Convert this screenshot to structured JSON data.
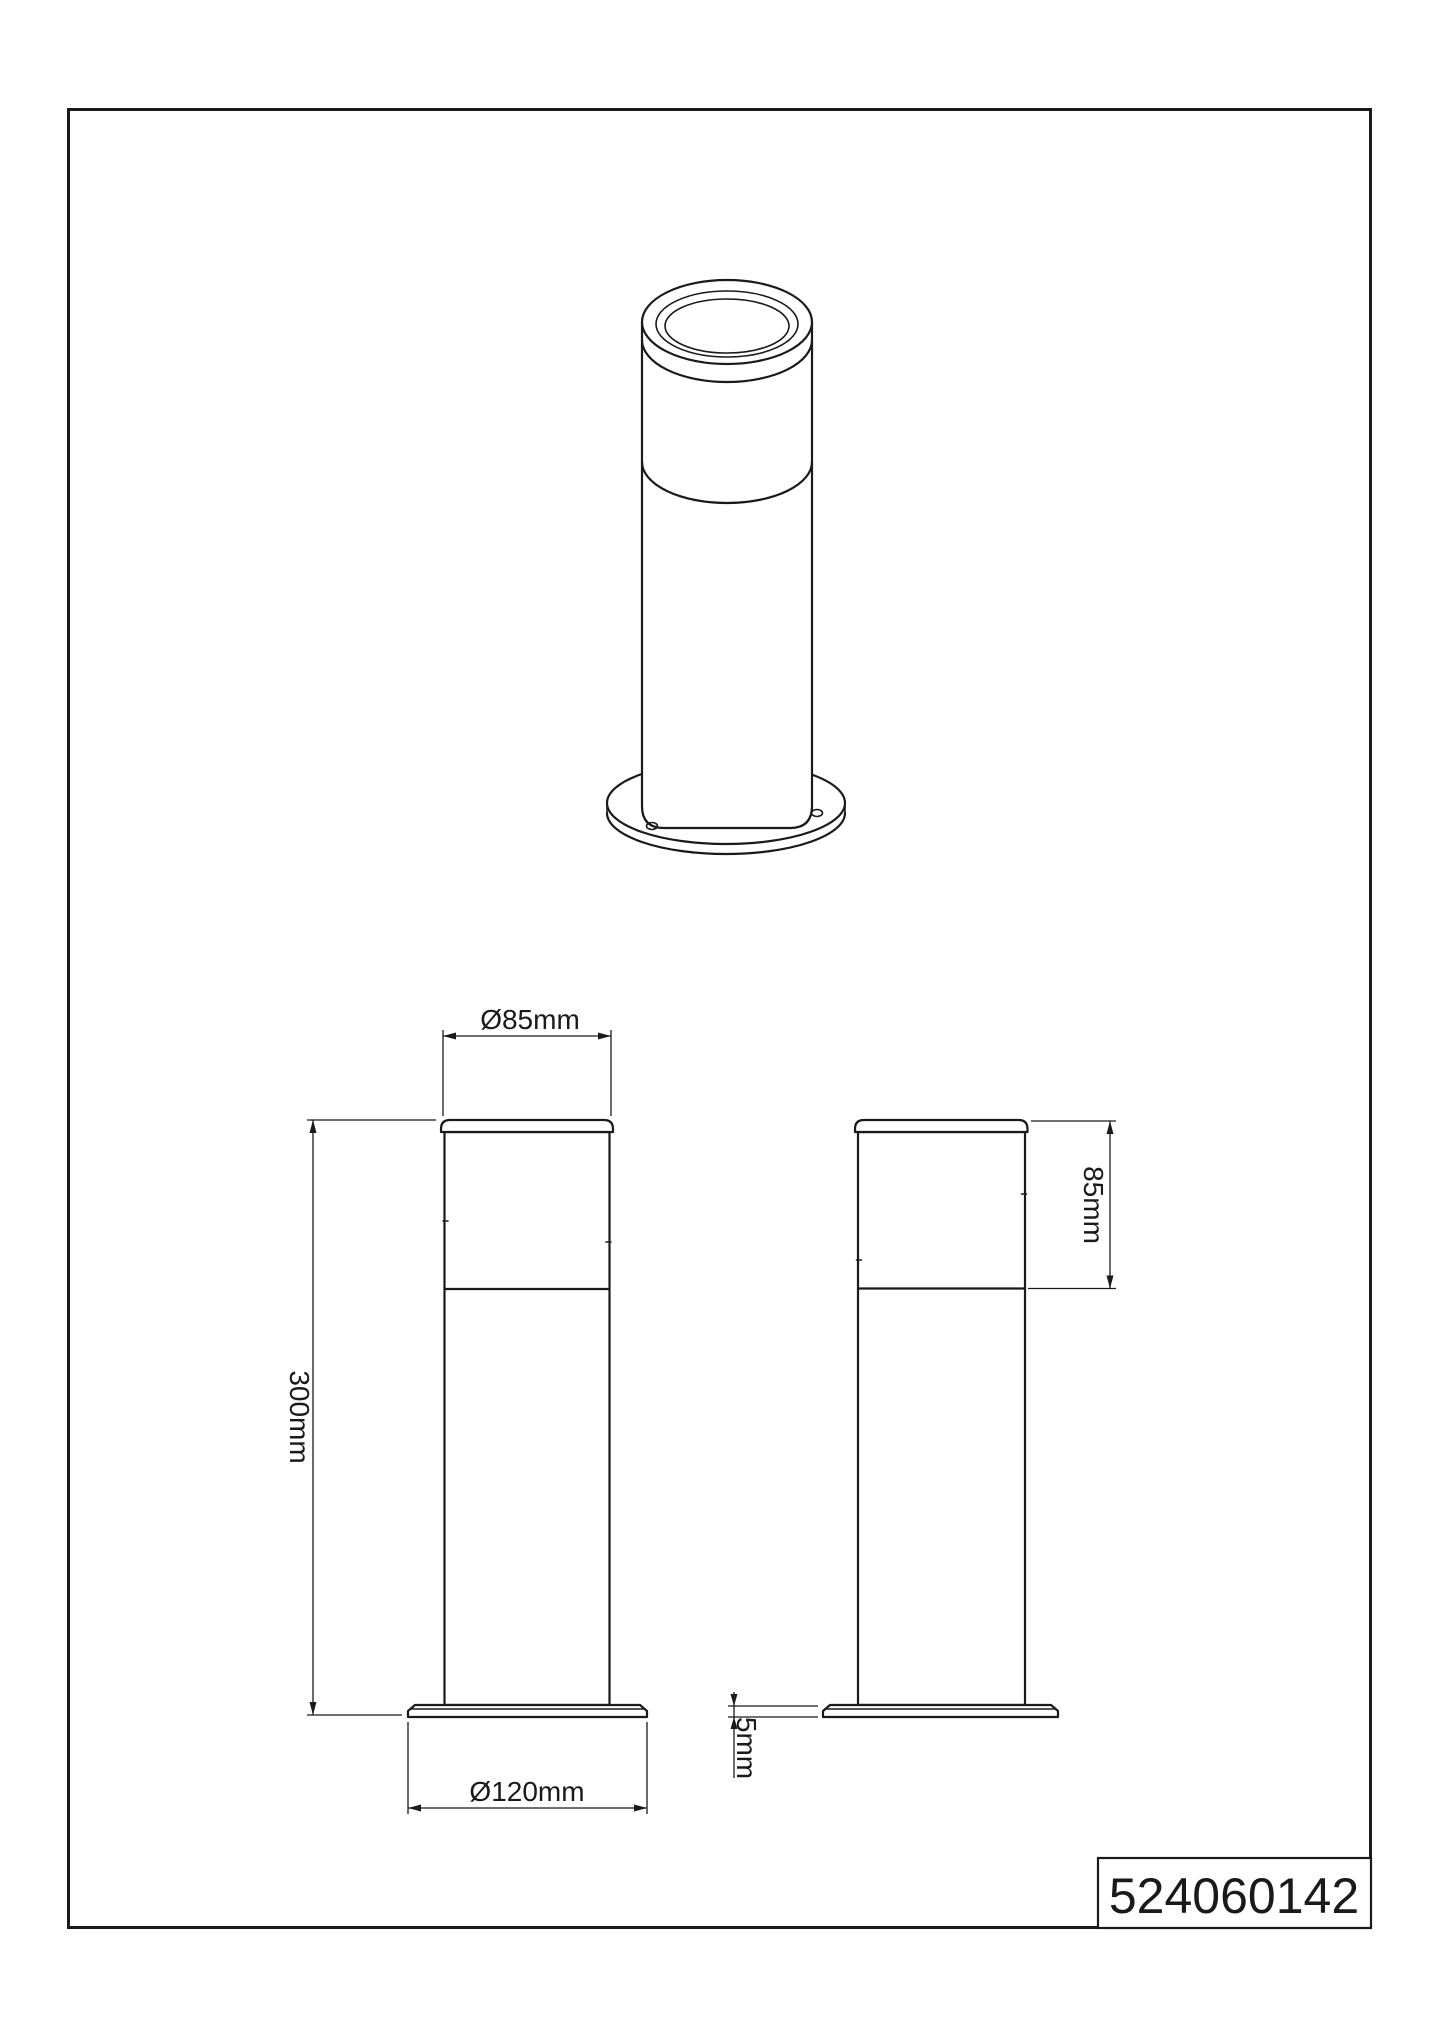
{
  "drawing": {
    "part_number": "524060142",
    "dimensions": {
      "top_diameter": "Ø85mm",
      "total_height": "300mm",
      "base_diameter": "Ø120mm",
      "diffuser_height": "85mm",
      "base_thickness": "5mm"
    },
    "colors": {
      "line": "#1a1a1a",
      "background": "#ffffff"
    }
  }
}
